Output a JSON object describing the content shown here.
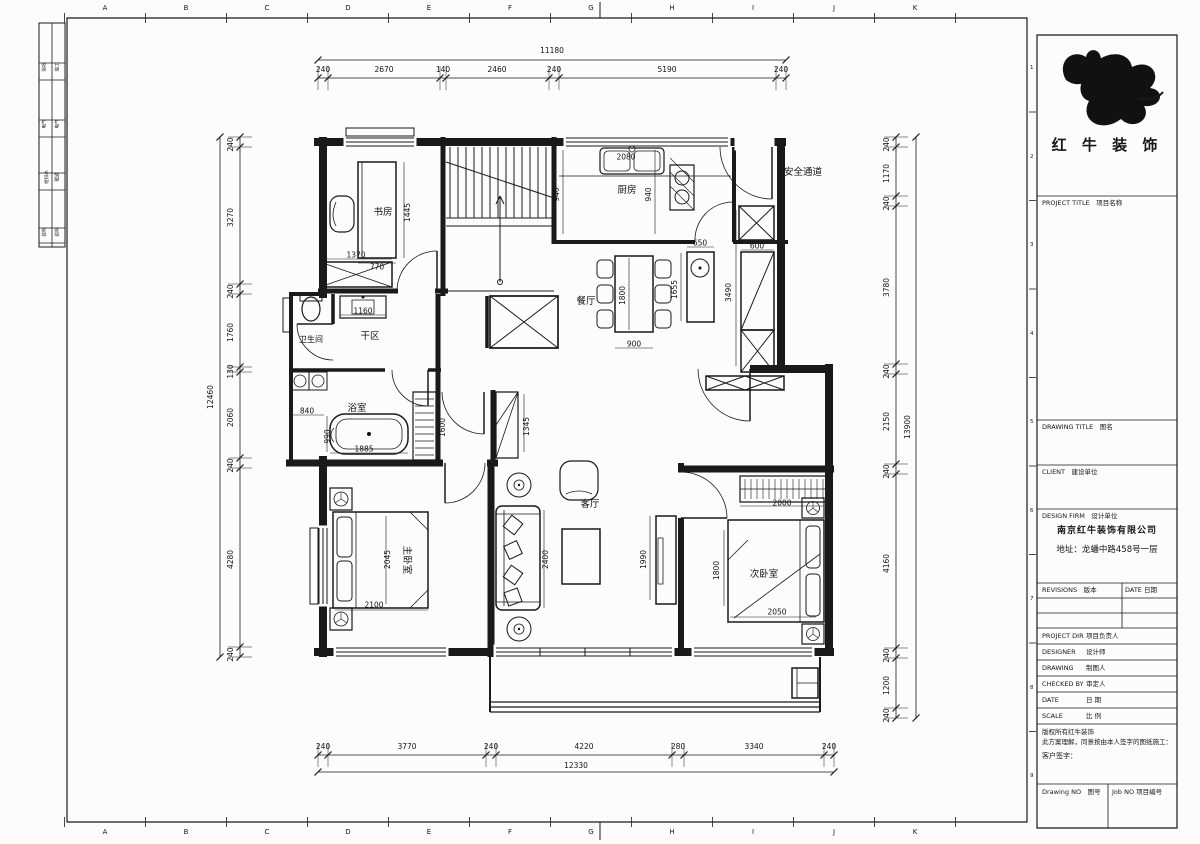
{
  "frame": {
    "top_letters": [
      "A",
      "B",
      "C",
      "D",
      "E",
      "F",
      "G",
      "H",
      "I",
      "J",
      "K"
    ],
    "side_numbers": [
      "1",
      "2",
      "3",
      "4",
      "5",
      "6",
      "7",
      "8",
      "9"
    ],
    "left_strip_rows": [
      [
        "验收",
        "竣工"
      ],
      [
        "电气",
        "电气"
      ],
      [
        "给排水",
        "暖通"
      ],
      [
        "结构",
        "结构"
      ]
    ]
  },
  "title_block": {
    "brand": "红 牛 装 饰",
    "project_title": "PROJECT TITLE　项目名称",
    "drawing_title": "DRAWING TITLE　图名",
    "client": "CLIENT　建设单位",
    "design_firm": "DESIGN FIRM　设计单位",
    "company": "南京红牛装饰有限公司",
    "address": "地址：龙蟠中路458号一层",
    "revisions": "REVISIONS　版本",
    "date_header": "DATE 日期",
    "rows": [
      {
        "en": "PROJECT DIR",
        "zh": "项目负责人"
      },
      {
        "en": "DESIGNER",
        "zh": "设计师"
      },
      {
        "en": "DRAWING",
        "zh": "制图人"
      },
      {
        "en": "CHECKED BY",
        "zh": "审定人"
      },
      {
        "en": "DATE",
        "zh": "日  期"
      },
      {
        "en": "SCALE",
        "zh": "比  例"
      }
    ],
    "copyright_line1": "版权所有红牛装饰",
    "copyright_line2": "此方案理解，同意按由本人签字的图纸施工：",
    "signature": "客户签字：",
    "drawing_no": "Drawing NO　图号",
    "job_no": "Job NO 项目编号"
  },
  "plan": {
    "room_labels": [
      {
        "t": "书房",
        "x": 383,
        "y": 212,
        "s": 9.5
      },
      {
        "t": "厨房",
        "x": 627,
        "y": 190,
        "s": 9.5
      },
      {
        "t": "餐厅",
        "x": 586,
        "y": 301,
        "s": 9.5
      },
      {
        "t": "卫生间",
        "x": 311,
        "y": 339,
        "s": 8
      },
      {
        "t": "干区",
        "x": 370,
        "y": 336,
        "s": 9.5
      },
      {
        "t": "浴室",
        "x": 357,
        "y": 408,
        "s": 9.5
      },
      {
        "t": "客厅",
        "x": 590,
        "y": 504,
        "s": 9.5
      },
      {
        "t": "主卧室",
        "x": 404,
        "y": 557,
        "r": 90,
        "s": 9.5
      },
      {
        "t": "次卧室",
        "x": 764,
        "y": 574,
        "s": 9.5
      },
      {
        "t": "安全通道",
        "x": 803,
        "y": 172,
        "s": 9.5
      }
    ],
    "dim_labels": [
      {
        "t": "1445",
        "x": 410,
        "y": 210,
        "r": -90
      },
      {
        "t": "770",
        "x": 377,
        "y": 267
      },
      {
        "t": "1370",
        "x": 356,
        "y": 255
      },
      {
        "t": "2080",
        "x": 626,
        "y": 157
      },
      {
        "t": "940",
        "x": 559,
        "y": 192,
        "r": -90
      },
      {
        "t": "940",
        "x": 651,
        "y": 192,
        "r": -90
      },
      {
        "t": "1800",
        "x": 625,
        "y": 293,
        "r": -90
      },
      {
        "t": "900",
        "x": 634,
        "y": 344
      },
      {
        "t": "650",
        "x": 700,
        "y": 243
      },
      {
        "t": "1655",
        "x": 677,
        "y": 287,
        "r": -90
      },
      {
        "t": "3490",
        "x": 731,
        "y": 290,
        "r": -90
      },
      {
        "t": "600",
        "x": 757,
        "y": 246
      },
      {
        "t": "1160",
        "x": 363,
        "y": 311
      },
      {
        "t": "840",
        "x": 307,
        "y": 411
      },
      {
        "t": "990",
        "x": 330,
        "y": 434,
        "r": -90
      },
      {
        "t": "1885",
        "x": 364,
        "y": 449
      },
      {
        "t": "1600",
        "x": 445,
        "y": 425,
        "r": -90
      },
      {
        "t": "1345",
        "x": 529,
        "y": 424,
        "r": -90
      },
      {
        "t": "2045",
        "x": 390,
        "y": 557,
        "r": -90
      },
      {
        "t": "2100",
        "x": 374,
        "y": 605
      },
      {
        "t": "2400",
        "x": 548,
        "y": 557,
        "r": -90
      },
      {
        "t": "1990",
        "x": 646,
        "y": 557,
        "r": -90
      },
      {
        "t": "1800",
        "x": 719,
        "y": 568,
        "r": -90
      },
      {
        "t": "2000",
        "x": 782,
        "y": 503
      },
      {
        "t": "2050",
        "x": 777,
        "y": 612
      }
    ],
    "chains": [
      {
        "o": "h",
        "line": 78,
        "lab": 72,
        "ticks": [
          318,
          328,
          440,
          446,
          549,
          559,
          776,
          786
        ],
        "labels": [
          [
            "240",
            323
          ],
          [
            "2670",
            384
          ],
          [
            "140",
            443
          ],
          [
            "2460",
            497
          ],
          [
            "240",
            554
          ],
          [
            "5190",
            667
          ],
          [
            "240",
            781
          ]
        ],
        "total": {
          "t": "11180",
          "line": 60,
          "a": 318,
          "b": 786,
          "lp": 552,
          "lo": 53
        }
      },
      {
        "o": "h",
        "line": 755,
        "lab": 749,
        "ticks": [
          318,
          328,
          486,
          496,
          672,
          684,
          824,
          834
        ],
        "labels": [
          [
            "240",
            323
          ],
          [
            "3770",
            407
          ],
          [
            "240",
            491
          ],
          [
            "4220",
            584
          ],
          [
            "280",
            678
          ],
          [
            "3340",
            754
          ],
          [
            "240",
            829
          ]
        ],
        "total": {
          "t": "12330",
          "line": 772,
          "a": 318,
          "b": 834,
          "lp": 576,
          "lo": 768
        }
      },
      {
        "o": "v",
        "line": 240,
        "lab": 233,
        "ticks": [
          137,
          147,
          284,
          294,
          367,
          372,
          458,
          468,
          647,
          657
        ],
        "labels": [
          [
            "240",
            142
          ],
          [
            "3270",
            215
          ],
          [
            "240",
            289
          ],
          [
            "1760",
            330
          ],
          [
            "130",
            369
          ],
          [
            "2060",
            415
          ],
          [
            "240",
            463
          ],
          [
            "4280",
            557
          ],
          [
            "240",
            652
          ]
        ],
        "total": {
          "t": "12460",
          "line": 220,
          "a": 137,
          "b": 657,
          "lp": 213,
          "lo": 397
        }
      },
      {
        "o": "v",
        "line": 896,
        "lab": 889,
        "ticks": [
          137,
          147,
          196,
          206,
          364,
          374,
          464,
          474,
          648,
          658,
          708,
          718
        ],
        "labels": [
          [
            "240",
            142
          ],
          [
            "1170",
            171
          ],
          [
            "240",
            201
          ],
          [
            "3780",
            285
          ],
          [
            "240",
            369
          ],
          [
            "2150",
            419
          ],
          [
            "240",
            469
          ],
          [
            "4160",
            561
          ],
          [
            "240",
            653
          ],
          [
            "1200",
            683
          ],
          [
            "240",
            713
          ]
        ],
        "total": {
          "t": "13900",
          "line": 916,
          "a": 137,
          "b": 718,
          "lp": 910,
          "lo": 427
        }
      }
    ]
  }
}
